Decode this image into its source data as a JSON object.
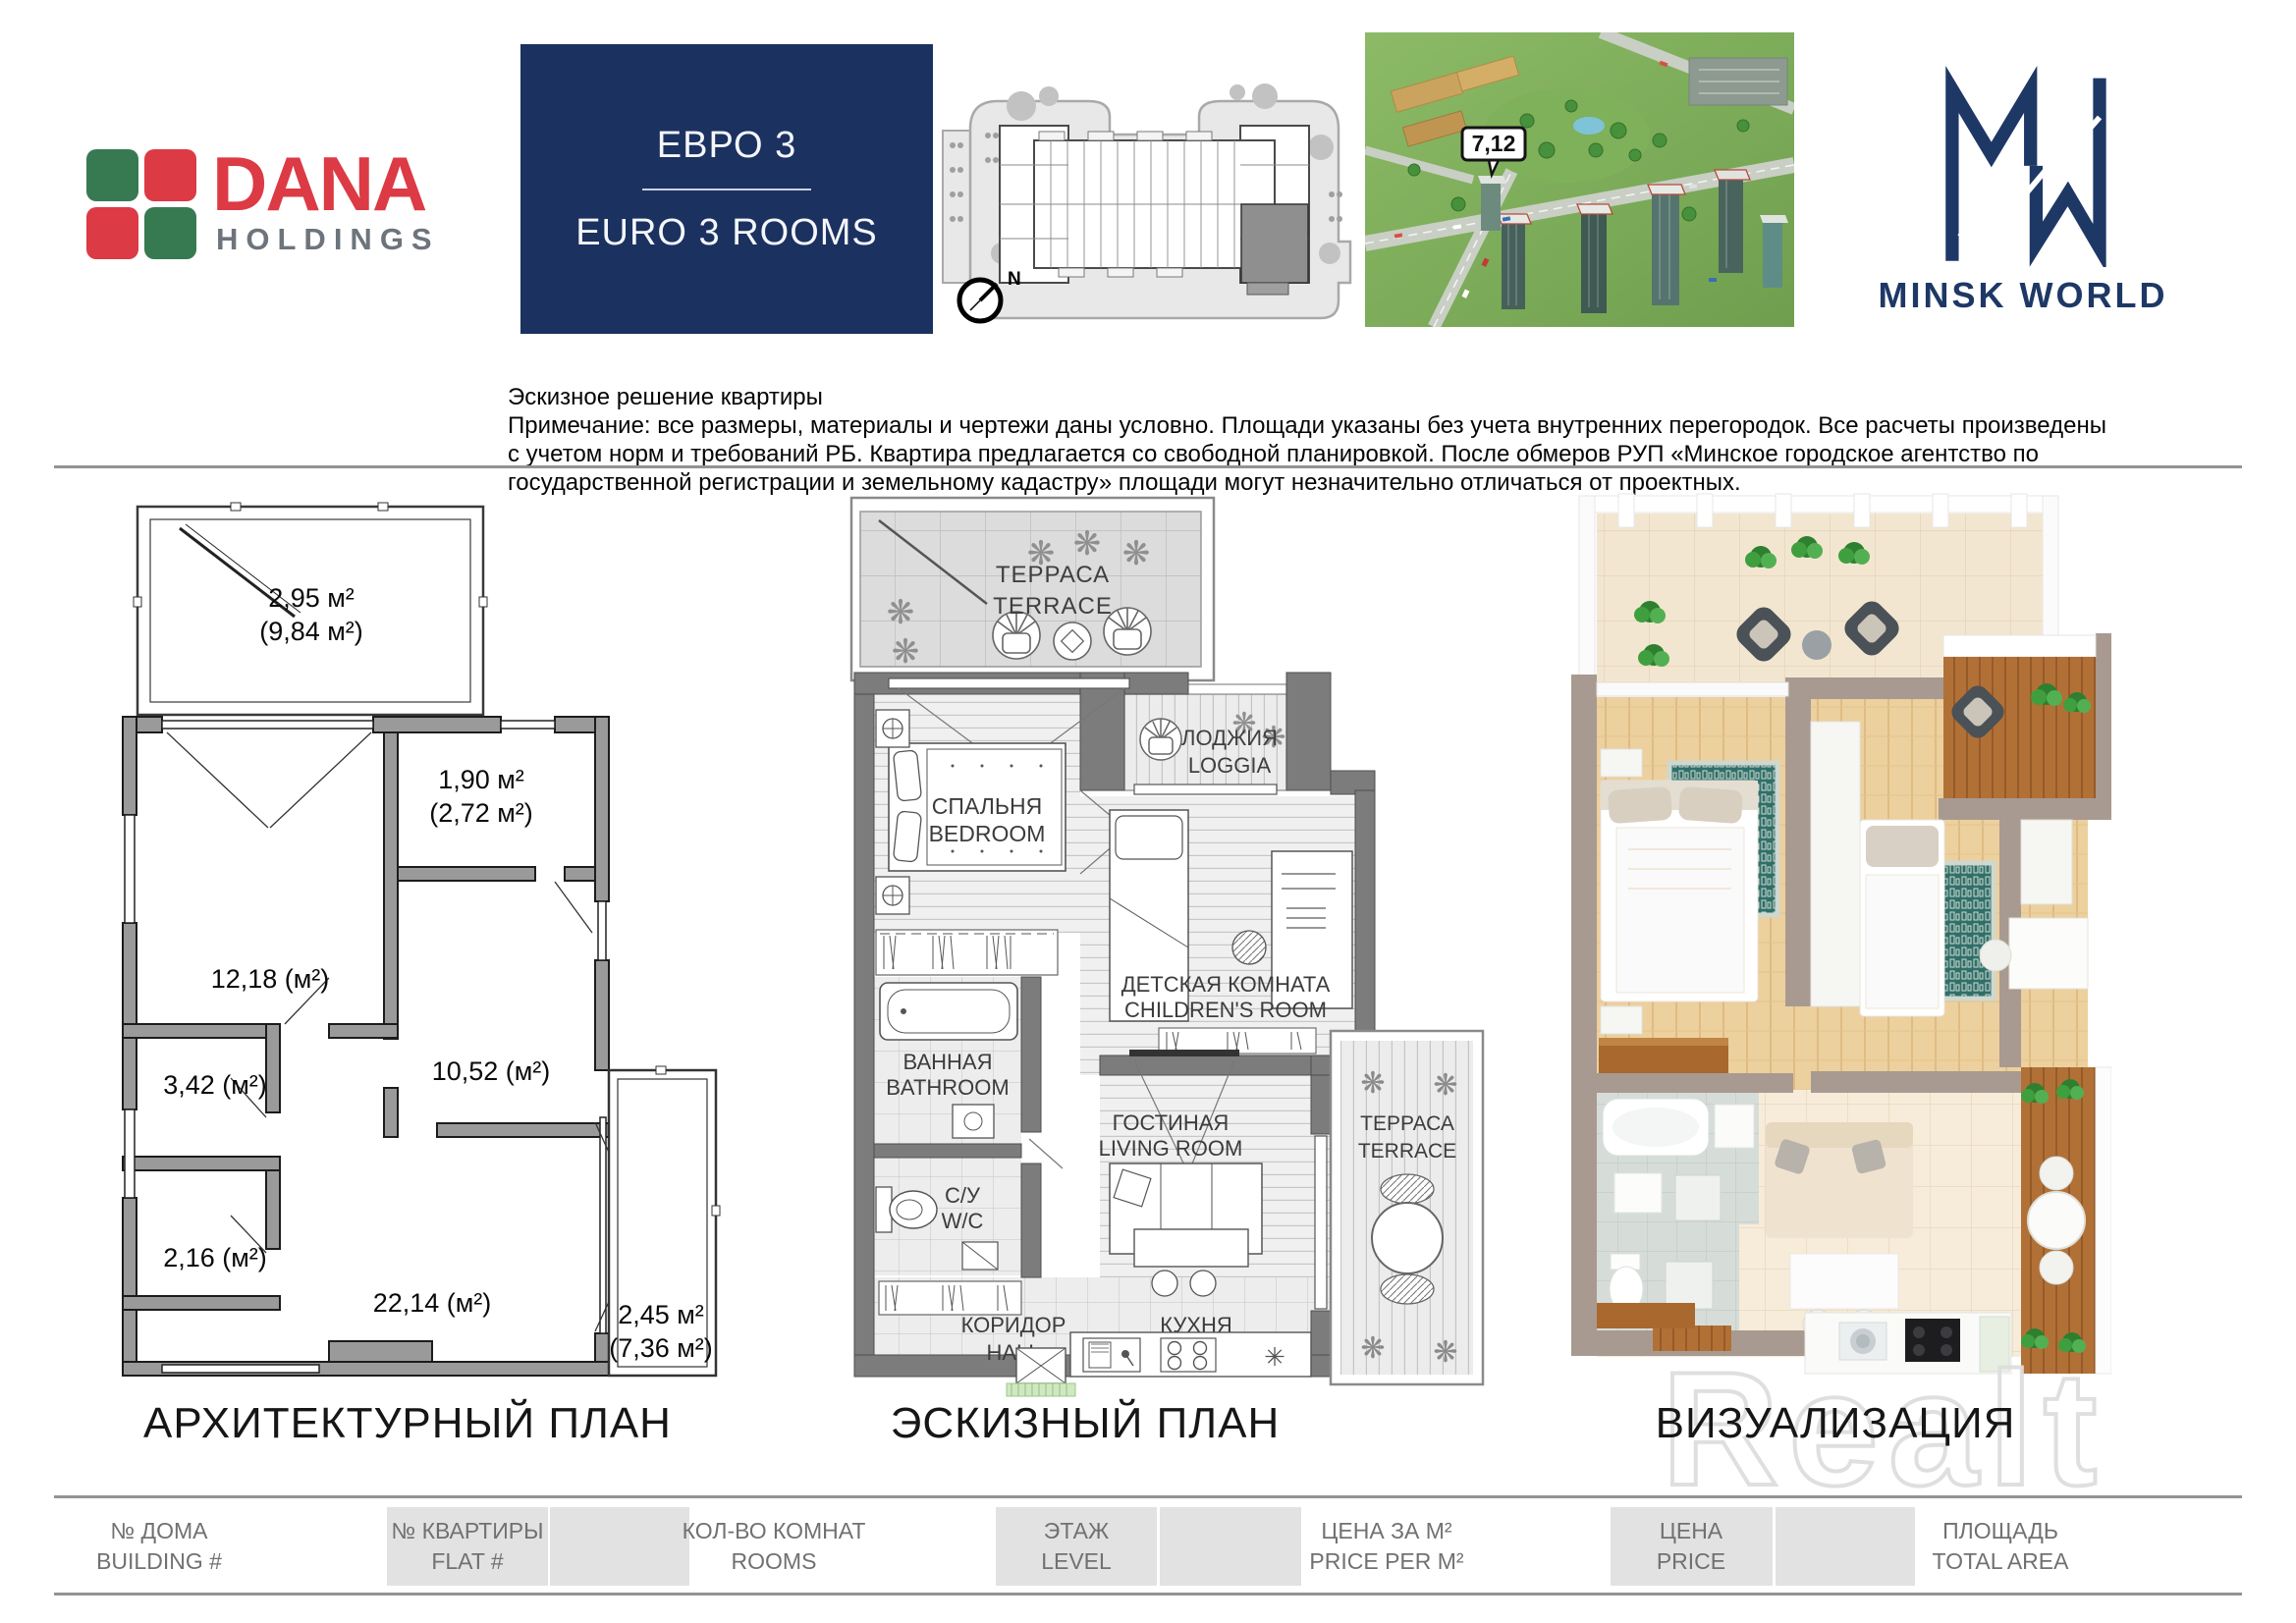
{
  "colors": {
    "navy_box": "#1b3160",
    "logo_navy": "#1e3866",
    "dana_red": "#dc3a45",
    "dana_green": "#377a52",
    "holdings_gray": "#6d747b",
    "arch_wall_gray": "#9a9a9a",
    "sketch_wall_gray": "#7c7c7c",
    "viz_wall_taupe": "#a89a90",
    "teal_rug": "#2f6f69",
    "footer_box_gray": "#e2e2e2",
    "rule_gray": "#939393"
  },
  "header": {
    "dana": {
      "word": "DANA",
      "sub": "HOLDINGS"
    },
    "unit_box": {
      "ru": "ЕВРО 3",
      "en": "EURO 3 ROOMS"
    },
    "floor_overview": {
      "compass": "N"
    },
    "aerial": {
      "building_badge": "7,12"
    },
    "minsk_world": {
      "wordmark": "MINSK WORLD"
    }
  },
  "disclaimer": {
    "line1": "Эскизное решение квартиры",
    "line2": "Примечание: все размеры, материалы и чертежи даны условно. Площади указаны без учета внутренних перегородок. Все расчеты произведены",
    "line3": "с учетом норм и требований РБ. Квартира предлагается со свободной планировкой. После обмеров РУП «Минское городское агентство по",
    "line4": "государственной регистрации и земельному кадастру» площади могут незначительно отличаться от проектных."
  },
  "architectural_plan": {
    "caption": "АРХИТЕКТУРНЫЙ ПЛАН",
    "areas": {
      "terrace_value": "2,95 м²",
      "terrace_total": "(9,84 м²)",
      "loggia_value": "1,90 м²",
      "loggia_total": "(2,72 м²)",
      "bedroom": "12,18 (м²)",
      "children": "10,52 (м²)",
      "bathroom": "3,42 (м²)",
      "wc": "2,16 (м²)",
      "living": "22,14 (м²)",
      "terrace2_value": "2,45 м²",
      "terrace2_total": "(7,36 м²)"
    }
  },
  "sketch_plan": {
    "caption": "ЭСКИЗНЫЙ ПЛАН",
    "rooms": {
      "terrace_ru": "ТЕРРАСА",
      "terrace_en": "TERRACE",
      "loggia_ru": "ЛОДЖИЯ",
      "loggia_en": "LOGGIA",
      "bedroom_ru": "СПАЛЬНЯ",
      "bedroom_en": "BEDROOM",
      "children_ru": "ДЕТСКАЯ КОМНАТА",
      "children_en": "CHILDREN'S ROOM",
      "bathroom_ru": "ВАННАЯ",
      "bathroom_en": "BATHROOM",
      "wc_ru": "С/У",
      "wc_en": "W/C",
      "living_ru": "ГОСТИНАЯ",
      "living_en": "LIVING ROOM",
      "hall_ru": "КОРИДОР",
      "hall_en": "HALL",
      "kitchen_ru": "КУХНЯ",
      "kitchen_en": "KITCHEN",
      "terrace2_ru": "ТЕРРАСА",
      "terrace2_en": "TERRACE"
    }
  },
  "visualization": {
    "caption": "ВИЗУАЛИЗАЦИЯ"
  },
  "footer": {
    "f1": {
      "ru": "№ ДОМА",
      "en": "BUILDING #"
    },
    "f2": {
      "ru": "№ КВАРТИРЫ",
      "en": "FLAT #"
    },
    "f3": {
      "ru": "КОЛ-ВО КОМНАТ",
      "en": "ROOMS"
    },
    "f4": {
      "ru": "ЭТАЖ",
      "en": "LEVEL"
    },
    "f5": {
      "ru": "ЦЕНА ЗА М²",
      "en": "PRICE PER M²"
    },
    "f6": {
      "ru": "ЦЕНА",
      "en": "PRICE"
    },
    "f7": {
      "ru": "ПЛОЩАДЬ",
      "en": "TOTAL AREA"
    }
  },
  "watermark": "Realt"
}
